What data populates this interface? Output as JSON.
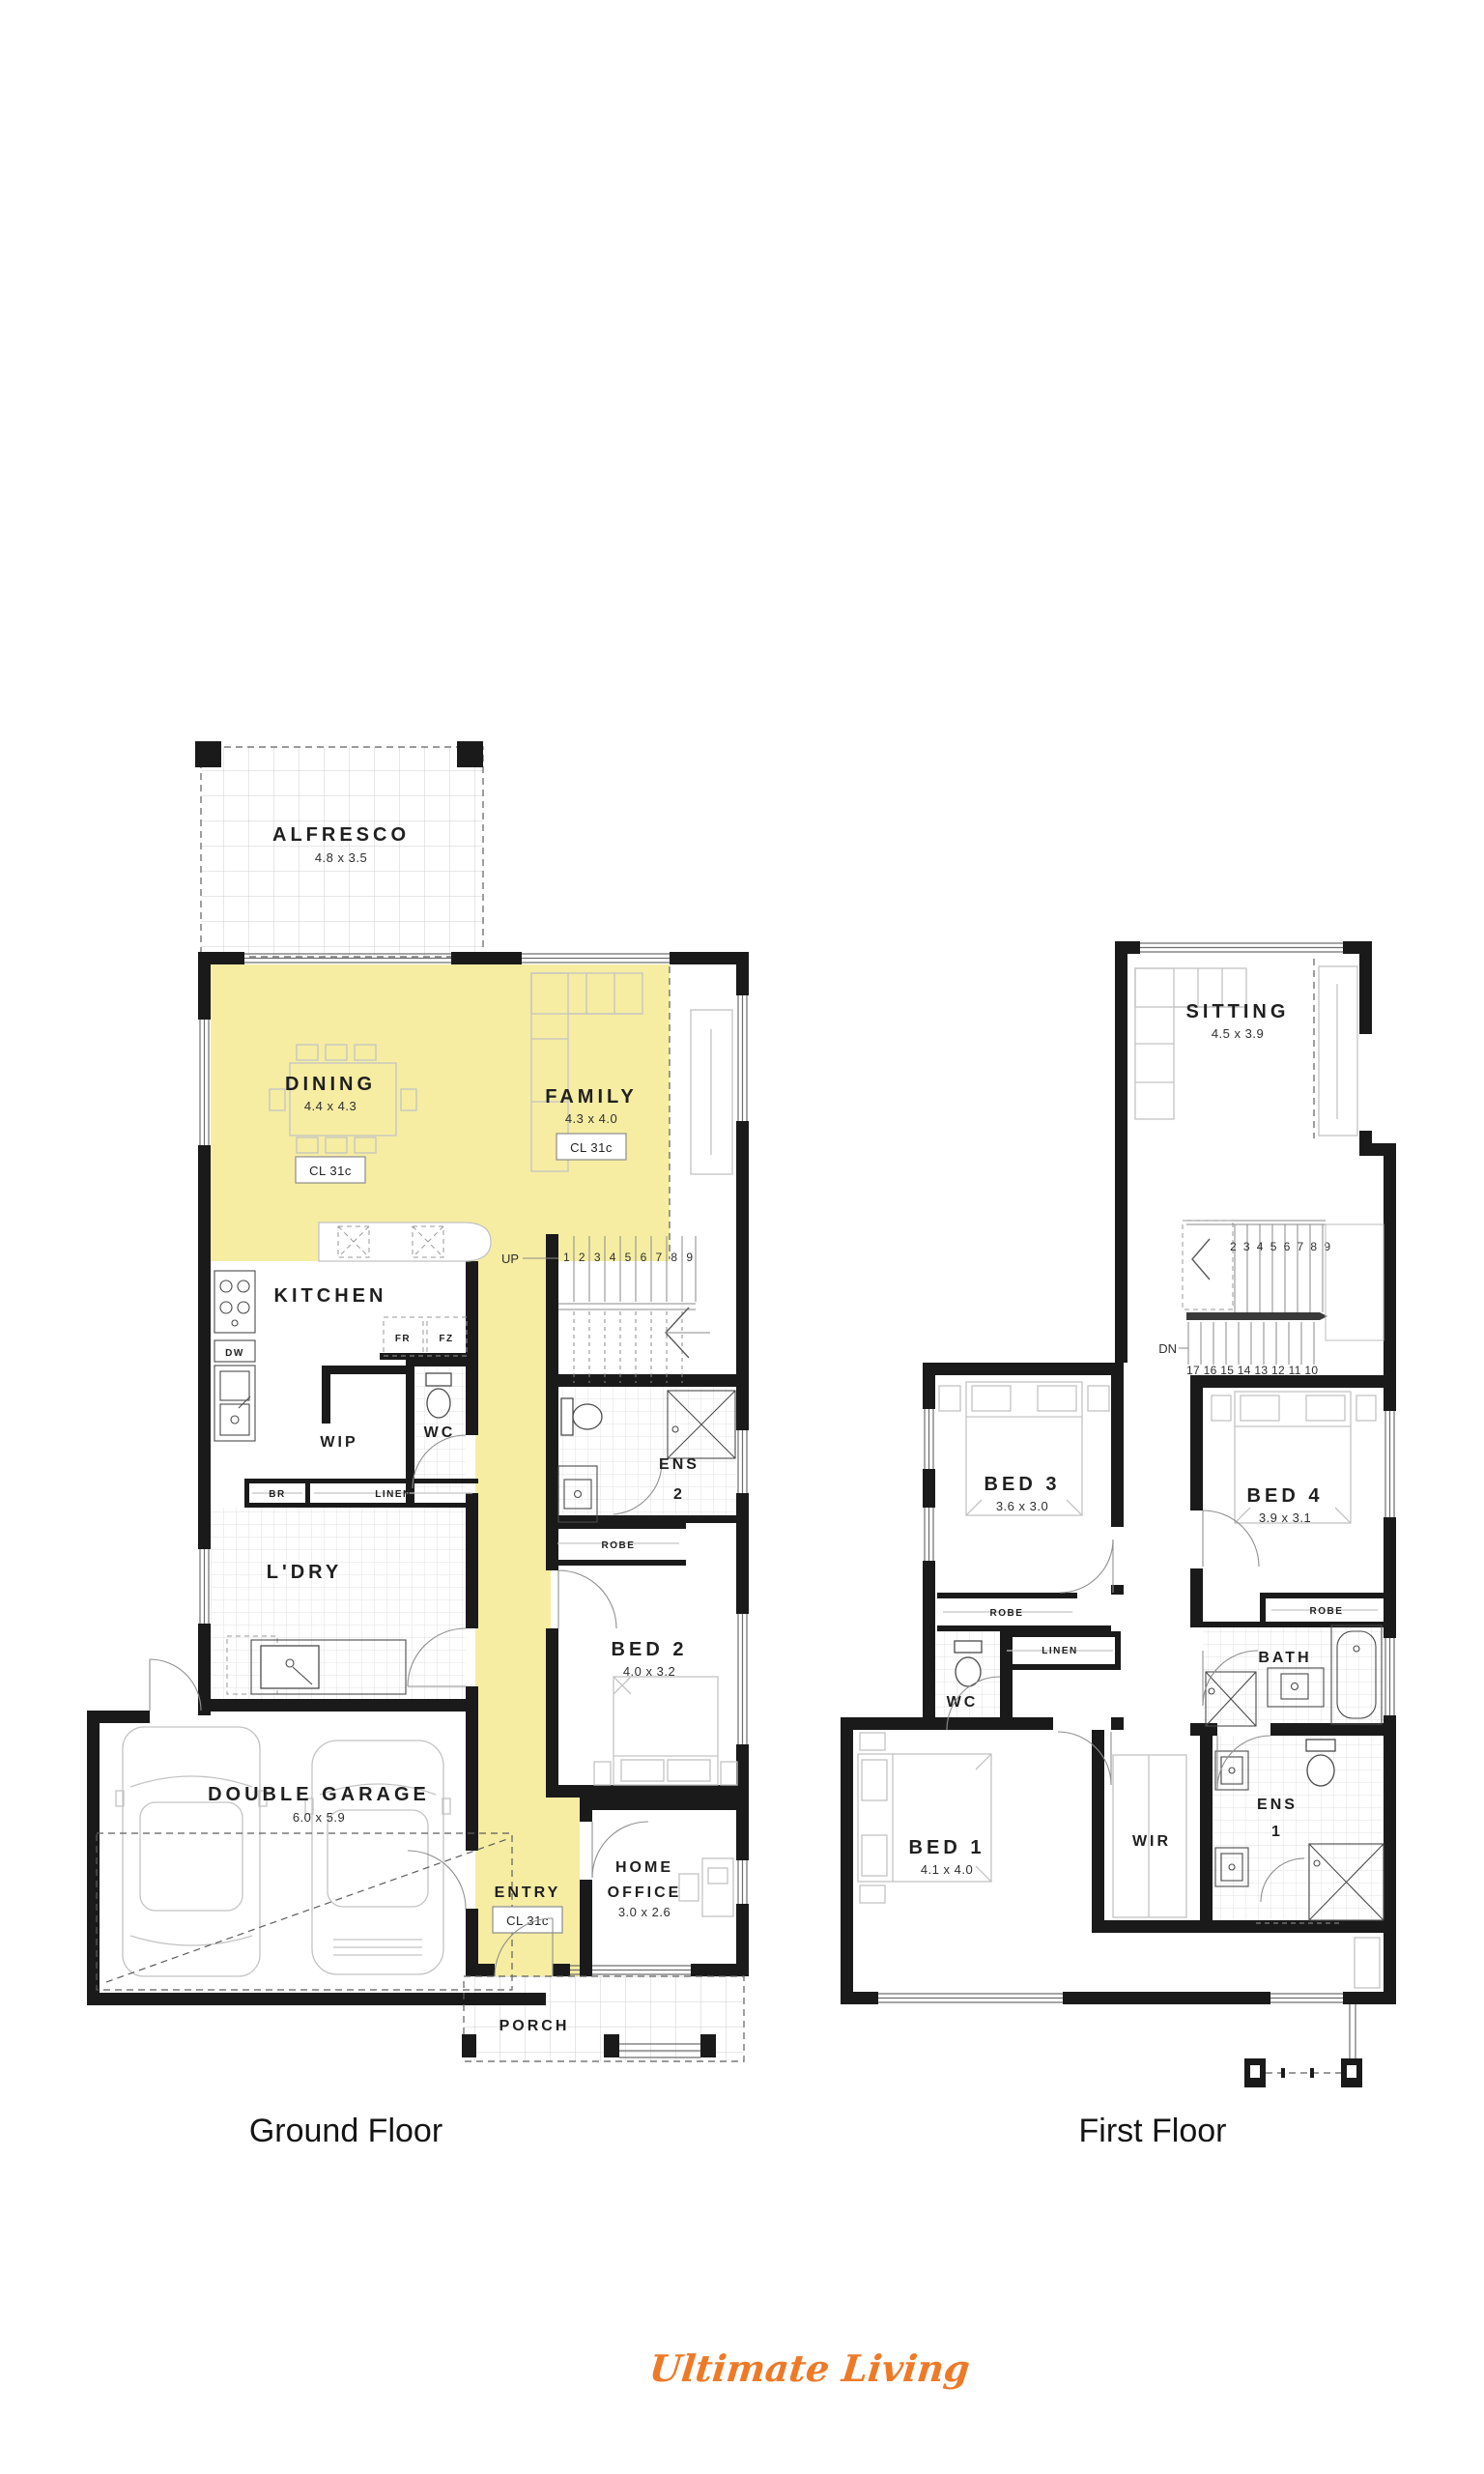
{
  "palette": {
    "highlight": "#F6EDA3",
    "wall": "#1a1a1a",
    "brand_orange": "#EE7A28"
  },
  "ground": {
    "caption": "Ground Floor",
    "alfresco": {
      "label": "ALFRESCO",
      "dims": "4.8 x 3.5"
    },
    "dining": {
      "label": "DINING",
      "dims": "4.4 x 4.3",
      "cl": "CL 31c"
    },
    "family": {
      "label": "FAMILY",
      "dims": "4.3 x 4.0",
      "cl": "CL 31c"
    },
    "kitchen": {
      "label": "KITCHEN"
    },
    "wip": {
      "label": "WIP"
    },
    "wc": {
      "label": "WC"
    },
    "fr": "FR",
    "fz": "FZ",
    "dw": "DW",
    "br": "BR",
    "linen": "LINEN",
    "stairs": {
      "up": "UP",
      "numbers": "1 2 3 4 5 6 7 8 9"
    },
    "ens2": {
      "line1": "ENS",
      "line2": "2"
    },
    "robe": "ROBE",
    "bed2": {
      "label": "BED 2",
      "dims": "4.0 x 3.2"
    },
    "ldry": {
      "label": "L'DRY"
    },
    "garage": {
      "label": "DOUBLE GARAGE",
      "dims": "6.0 x 5.9"
    },
    "entry": {
      "label": "ENTRY",
      "cl": "CL 31c"
    },
    "office": {
      "line1": "HOME",
      "line2": "OFFICE",
      "dims": "3.0 x 2.6"
    },
    "porch": {
      "label": "PORCH"
    }
  },
  "first": {
    "caption": "First Floor",
    "sitting": {
      "label": "SITTING",
      "dims": "4.5 x 3.9"
    },
    "stairs": {
      "dn": "DN",
      "top": "2 3 4 5 6 7 8 9",
      "bottom": "17 16 15 14 13 12 11 10"
    },
    "bed3": {
      "label": "BED 3",
      "dims": "3.6 x 3.0"
    },
    "bed4": {
      "label": "BED 4",
      "dims": "3.9 x 3.1"
    },
    "robe3": "ROBE",
    "robe4": "ROBE",
    "linen": "LINEN",
    "wc": {
      "label": "WC"
    },
    "bath": {
      "label": "BATH"
    },
    "ens1": {
      "line1": "ENS",
      "line2": "1"
    },
    "wir": {
      "label": "WIR"
    },
    "bed1": {
      "label": "BED 1",
      "dims": "4.1 x 4.0"
    }
  },
  "brand": {
    "name": "Ultimate Living"
  }
}
